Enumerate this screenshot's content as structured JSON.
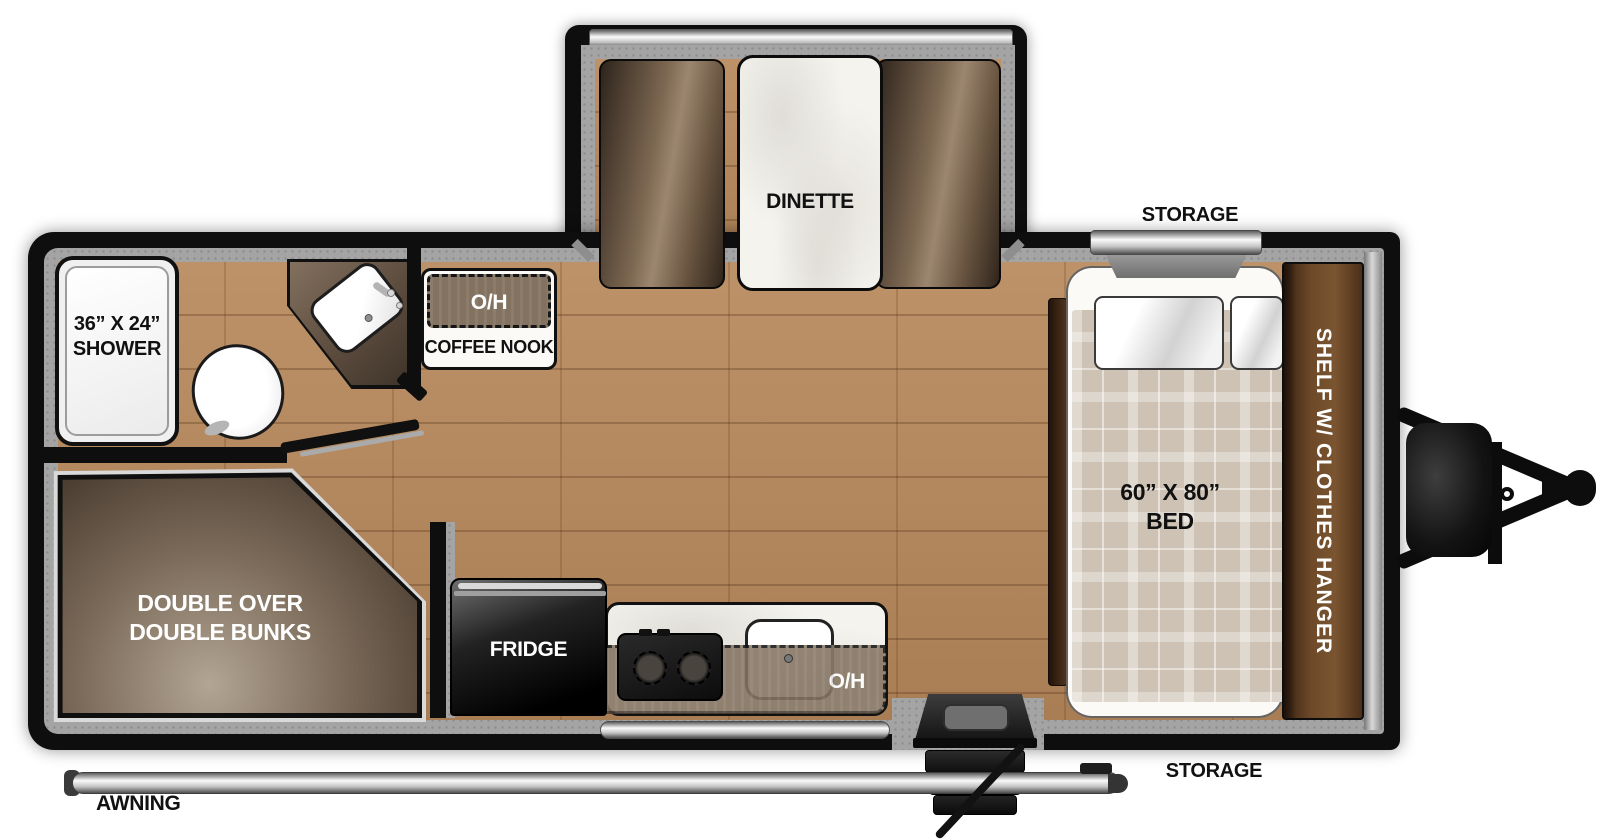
{
  "floorplan": {
    "title": "travel-trailer-floorplan",
    "slideout": {
      "dinette": "DINETTE"
    },
    "bathroom": {
      "shower_line1": "36” X 24”",
      "shower_line2": "SHOWER"
    },
    "coffee_nook": {
      "oh": "O/H",
      "label": "COFFEE NOOK"
    },
    "bunks": {
      "line1": "DOUBLE OVER",
      "line2": "DOUBLE BUNKS"
    },
    "kitchen": {
      "fridge": "FRIDGE",
      "oh": "O/H"
    },
    "bedroom": {
      "storage_top": "STORAGE",
      "bed_line1": "60” X 80”",
      "bed_line2": "BED",
      "wardrobe": "SHELF W/ CLOTHES HANGER",
      "storage_bottom": "STORAGE"
    },
    "exterior": {
      "awning": "AWNING"
    },
    "colors": {
      "wall": "#0e0e0e",
      "floor_wood": "#b5895f",
      "interior_trim": "#a4a4a4",
      "cabinet_brown": "#6e4a2a",
      "bunk_brown": "#6a5a4c",
      "marble": "#f5f3ee",
      "label_dark": "#111111",
      "label_light": "#ffffff"
    }
  }
}
